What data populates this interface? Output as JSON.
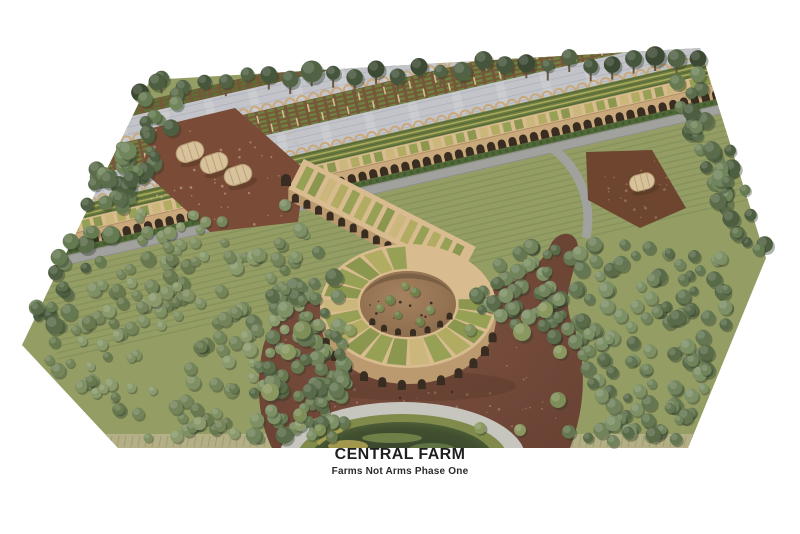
{
  "caption": {
    "title": "CENTRAL FARM",
    "subtitle": "Farms Not Arms Phase One"
  },
  "scene": {
    "type": "architectural-aerial-rendering",
    "elements": [
      "greenhouse-canopies",
      "crop-rows",
      "arched-arcade",
      "spiral-courtyard-building",
      "orchard-forest",
      "dome-tents",
      "pond",
      "plaza",
      "perimeter-tree-rows"
    ],
    "palette": {
      "background": "#ffffff",
      "ground": "#939d64",
      "canopy": "#c3c5cc",
      "canopyLine": "#aeb0ba",
      "cropSoil": "#77573a",
      "cropGreen": "#6e8140",
      "cropGreenDark": "#5a7034",
      "terraceBase": "#6d7c3e",
      "terraceLight": "#a9aa5e",
      "terraceDark": "#55683a",
      "arcadeTan": "#c9a97c",
      "archDark": "#382d20",
      "roofRib": "#d8bb8e",
      "roofGreen1": "#97a155",
      "roofGreen2": "#b2ab62",
      "roofGreen3": "#8b974e",
      "roofBeige": "#cbb67c",
      "wallTan": "#bb9a70",
      "courtyardLight": "#a5825f",
      "courtyardDark": "#8a6a4b",
      "dirt": "#7a4b36",
      "mulch": "#6e452f",
      "plazaLight": "#7c5040",
      "plazaDark": "#6a4334",
      "road": "#a1a19e",
      "hedge": "#4f6838",
      "grassStrip": "#b4af87",
      "grassStreak": "#8f9459",
      "pondPath": "#c6c6bf",
      "pondVeg": "#7f8a4b",
      "pondWaterEdge": "#54663e",
      "pondWaterDeep": "#333f2c",
      "pondAlgae": "#b3a653",
      "tentCanvas": "#d8c29b",
      "tentRib": "#b49a73",
      "trunk": "#6b5843",
      "treeShadow": "#2e3b28",
      "trees": {
        "backRow": [
          "#3c4a33",
          "#46563c",
          "#516245"
        ],
        "edge": [
          "#4e5f41",
          "#5a6c49",
          "#667a52",
          "#71855c"
        ],
        "orchard": [
          "#74855a",
          "#7f9063",
          "#68794f",
          "#8a9a6c"
        ],
        "forest": [
          "#647752",
          "#70835b",
          "#7d9066",
          "#596b48"
        ],
        "shrub": [
          "#7e8e58",
          "#8a985f"
        ],
        "courtyard": [
          "#6f8049",
          "#7b8c52"
        ]
      }
    }
  }
}
